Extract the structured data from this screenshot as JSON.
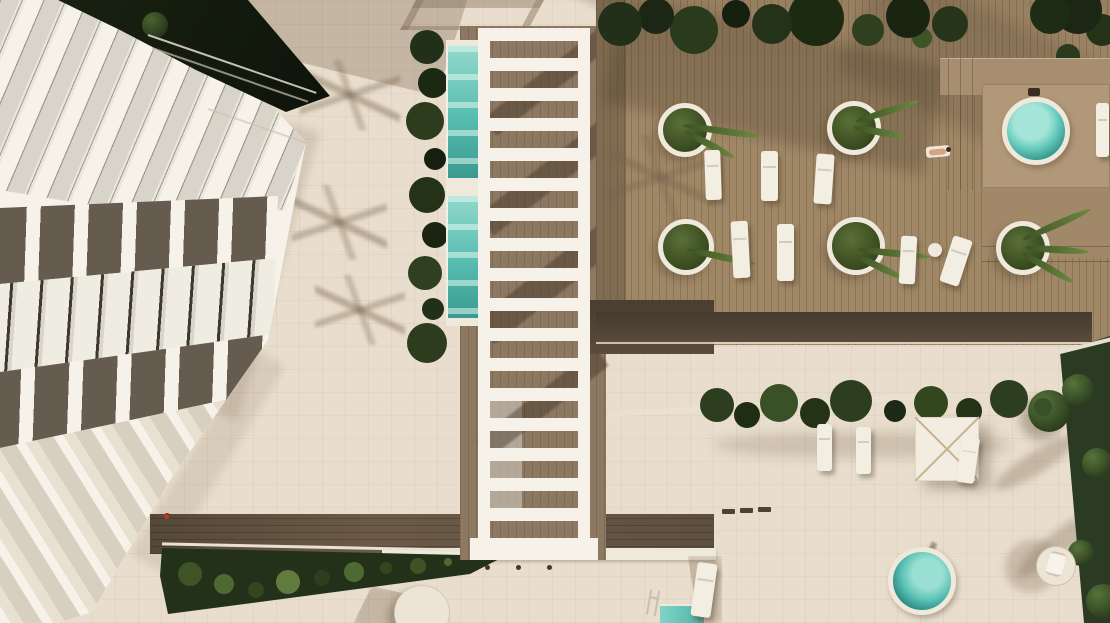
{
  "scene": {
    "type": "aerial-architectural-render",
    "setting": "resort apartment building with pergola, lap pool, wooden sun deck, hot tubs and garden"
  },
  "palette": {
    "paving": "#e9decd",
    "white_structure": "#f6f2e9",
    "curb": "#efe9dc",
    "glass": "#d8d4c9",
    "awning": "#655c4f",
    "wood_deck": "#a08766",
    "wood_dark": "#4c4033",
    "walkway": "#5e5040",
    "foliage_dark": "#1c2712",
    "foliage_mid": "#2c3c1d",
    "foliage_light": "#5f7c3e",
    "lawn": "#2b3a23",
    "pool_water": "#62c4b8",
    "pool_light": "#a9e2d8",
    "pool_deep": "#2f8e84",
    "lounger": "#f3eee2",
    "skin": "#d8a285",
    "accent_red": "#b23d2c"
  },
  "objects": [
    "apartment-building",
    "glass-facade",
    "awning-row",
    "window-row",
    "balcony-terraces",
    "roof-foliage",
    "roof-railing",
    "paving",
    "tile-grid",
    "palm-shadow",
    "lap-pool",
    "hedge",
    "pergola",
    "pergola-shadow",
    "under-pergola-deck",
    "wood-deck",
    "deck-foliage",
    "round-planter",
    "sun-lounger",
    "side-table",
    "sunbathing-person",
    "hot-tub",
    "deck-platform",
    "garden-lawn",
    "garden-tree",
    "plant-row",
    "shade-parasol",
    "round-daybed",
    "walkway",
    "walkway-curb",
    "path-light",
    "planter-bed",
    "round-parasol",
    "plunge-pool",
    "pool-ladder",
    "balcony-person"
  ]
}
